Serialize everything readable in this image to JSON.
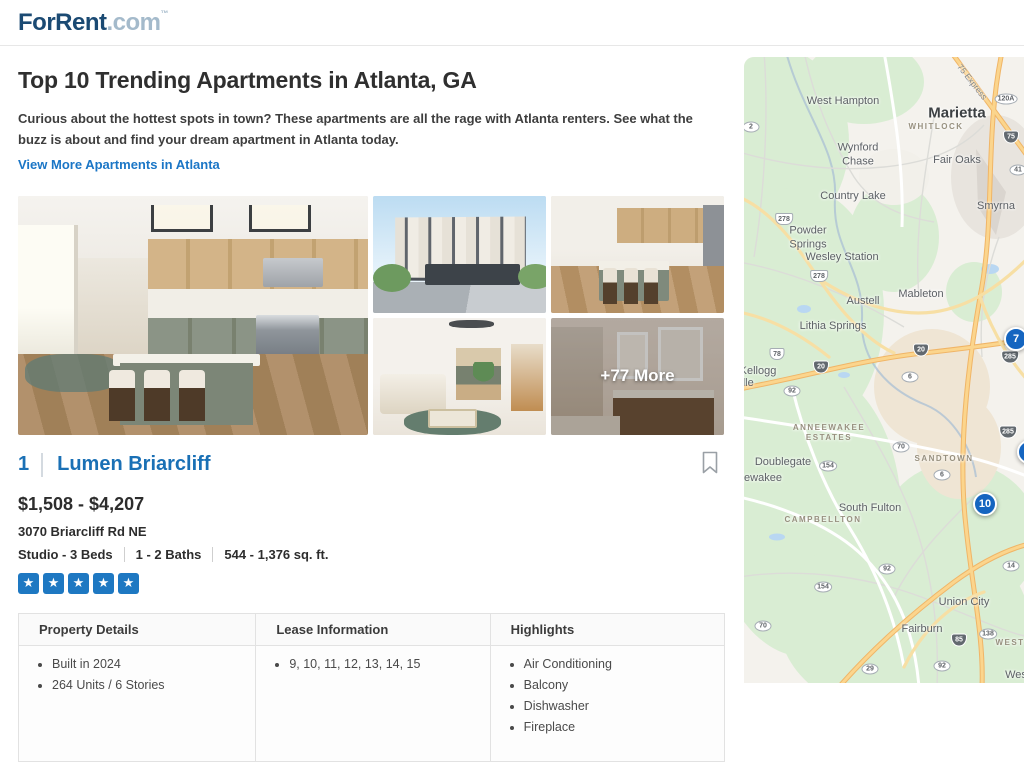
{
  "header": {
    "logo_primary": "ForRent",
    "logo_suffix": ".com",
    "logo_tm": "™"
  },
  "page": {
    "title": "Top 10 Trending Apartments in Atlanta, GA",
    "description": "Curious about the hottest spots in town? These apartments are all the rage with Atlanta renters. See what the buzz is about and find your dream apartment in Atlanta today.",
    "view_more_link": "View More Apartments in Atlanta"
  },
  "gallery": {
    "more_overlay": "+77 More"
  },
  "listing": {
    "rank": "1",
    "name": "Lumen Briarcliff",
    "price_range": "$1,508 - $4,207",
    "address": "3070 Briarcliff Rd NE",
    "beds": "Studio - 3 Beds",
    "baths": "1 - 2 Baths",
    "sqft": "544 - 1,376 sq. ft.",
    "rating": 5,
    "star_color": "#1e78c2"
  },
  "details_table": {
    "columns": [
      {
        "header": "Property Details",
        "items": [
          "Built in 2024",
          "264 Units / 6 Stories"
        ]
      },
      {
        "header": "Lease Information",
        "items": [
          "9, 10, 11, 12, 13, 14, 15"
        ]
      },
      {
        "header": "Highlights",
        "items": [
          "Air Conditioning",
          "Balcony",
          "Dishwasher",
          "Fireplace"
        ]
      }
    ]
  },
  "map": {
    "marker_color": "#1565c0",
    "labels": [
      {
        "t": "West Hampton",
        "x": 99,
        "y": 45,
        "k": "town"
      },
      {
        "t": "Marietta",
        "x": 213,
        "y": 57,
        "k": "city"
      },
      {
        "t": "WHITLOCK",
        "x": 192,
        "y": 70,
        "k": "hood"
      },
      {
        "t": "Wynford\nChase",
        "x": 114,
        "y": 98,
        "k": "town"
      },
      {
        "t": "Fair Oaks",
        "x": 213,
        "y": 104,
        "k": "town"
      },
      {
        "t": "Country Lake",
        "x": 109,
        "y": 140,
        "k": "town"
      },
      {
        "t": "Smyrna",
        "x": 252,
        "y": 150,
        "k": "town"
      },
      {
        "t": "Powder\nSprings",
        "x": 64,
        "y": 181,
        "k": "town"
      },
      {
        "t": "Wesley Station",
        "x": 98,
        "y": 201,
        "k": "town"
      },
      {
        "t": "Mableton",
        "x": 177,
        "y": 238,
        "k": "town"
      },
      {
        "t": "Austell",
        "x": 119,
        "y": 245,
        "k": "town"
      },
      {
        "t": "Lithia Springs",
        "x": 89,
        "y": 270,
        "k": "town"
      },
      {
        "t": "Kellogg",
        "x": 14,
        "y": 315,
        "k": "town"
      },
      {
        "t": "ille",
        "x": 3,
        "y": 327,
        "k": "town"
      },
      {
        "t": "ANNEEWAKEE\nESTATES",
        "x": 85,
        "y": 376,
        "k": "hood"
      },
      {
        "t": "Doublegate",
        "x": 39,
        "y": 406,
        "k": "town"
      },
      {
        "t": "SANDTOWN",
        "x": 200,
        "y": 402,
        "k": "hood"
      },
      {
        "t": "ewakee",
        "x": 19,
        "y": 422,
        "k": "town"
      },
      {
        "t": "South Fulton",
        "x": 126,
        "y": 452,
        "k": "town"
      },
      {
        "t": "CAMPBELLTON",
        "x": 79,
        "y": 463,
        "k": "hood"
      },
      {
        "t": "Union City",
        "x": 220,
        "y": 546,
        "k": "town"
      },
      {
        "t": "Fairburn",
        "x": 178,
        "y": 573,
        "k": "town"
      },
      {
        "t": "WEST",
        "x": 266,
        "y": 586,
        "k": "hood"
      },
      {
        "t": "Wes",
        "x": 272,
        "y": 619,
        "k": "town"
      },
      {
        "t": "75 Express",
        "x": 228,
        "y": 25,
        "k": "express"
      }
    ],
    "shields": [
      {
        "t": "120A",
        "x": 262,
        "y": 42,
        "k": "route"
      },
      {
        "t": "75",
        "x": 267,
        "y": 80,
        "k": "interstate"
      },
      {
        "t": "41",
        "x": 274,
        "y": 113,
        "k": "route"
      },
      {
        "t": "2",
        "x": 7,
        "y": 70,
        "k": "route"
      },
      {
        "t": "278",
        "x": 40,
        "y": 162,
        "k": "us"
      },
      {
        "t": "278",
        "x": 75,
        "y": 219,
        "k": "us"
      },
      {
        "t": "78",
        "x": 33,
        "y": 297,
        "k": "us"
      },
      {
        "t": "20",
        "x": 77,
        "y": 310,
        "k": "interstate"
      },
      {
        "t": "20",
        "x": 177,
        "y": 293,
        "k": "interstate"
      },
      {
        "t": "92",
        "x": 48,
        "y": 334,
        "k": "route"
      },
      {
        "t": "6",
        "x": 166,
        "y": 320,
        "k": "route"
      },
      {
        "t": "285",
        "x": 266,
        "y": 300,
        "k": "interstate"
      },
      {
        "t": "285",
        "x": 264,
        "y": 375,
        "k": "interstate"
      },
      {
        "t": "70",
        "x": 157,
        "y": 390,
        "k": "route"
      },
      {
        "t": "154",
        "x": 84,
        "y": 409,
        "k": "route"
      },
      {
        "t": "6",
        "x": 198,
        "y": 418,
        "k": "route"
      },
      {
        "t": "92",
        "x": 143,
        "y": 512,
        "k": "route"
      },
      {
        "t": "154",
        "x": 79,
        "y": 530,
        "k": "route"
      },
      {
        "t": "14",
        "x": 267,
        "y": 509,
        "k": "route"
      },
      {
        "t": "70",
        "x": 19,
        "y": 569,
        "k": "route"
      },
      {
        "t": "138",
        "x": 244,
        "y": 577,
        "k": "route"
      },
      {
        "t": "85",
        "x": 215,
        "y": 583,
        "k": "interstate"
      },
      {
        "t": "29",
        "x": 126,
        "y": 612,
        "k": "route"
      },
      {
        "t": "92",
        "x": 198,
        "y": 609,
        "k": "route"
      }
    ],
    "markers": [
      {
        "t": "7",
        "x": 272,
        "y": 282
      },
      {
        "t": "",
        "x": 285,
        "y": 395
      },
      {
        "t": "10",
        "x": 241,
        "y": 447
      }
    ]
  }
}
